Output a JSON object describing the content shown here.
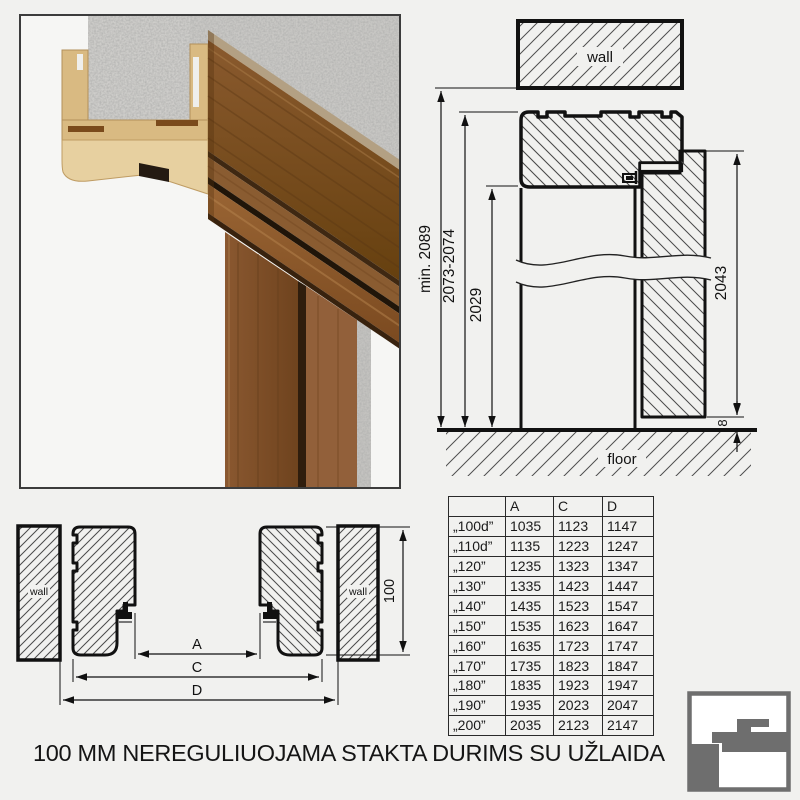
{
  "palette": {
    "logo_gray": "#6e6e6e",
    "wood_dark": "#7d4e28",
    "wood_light": "#9a6a3d",
    "mdf_tan": "#d9ba82",
    "concrete": "#cac9c6",
    "line": "#111111",
    "background": "#f1f1ef"
  },
  "caption": {
    "text": "100 MM NEREGULIUOJAMA STAKTA DURIMS SU UŽLAIDA"
  },
  "section": {
    "wall_label": "wall",
    "floor_label": "floor",
    "dims": {
      "min_total": "min. 2089",
      "frame_height": "2073-2074",
      "opening_height": "2029",
      "door_height": "2043",
      "floor_gap": "8"
    }
  },
  "plan": {
    "wall_label_left": "wall",
    "wall_label_right": "wall",
    "dims": {
      "a": "A",
      "c": "C",
      "d": "D",
      "frame_depth": "100"
    }
  },
  "table": {
    "headers": [
      "",
      "A",
      "C",
      "D"
    ],
    "rows": [
      [
        "„100d”",
        "1035",
        "1123",
        "1147"
      ],
      [
        "„110d”",
        "1135",
        "1223",
        "1247"
      ],
      [
        "„120”",
        "1235",
        "1323",
        "1347"
      ],
      [
        "„130”",
        "1335",
        "1423",
        "1447"
      ],
      [
        "„140”",
        "1435",
        "1523",
        "1547"
      ],
      [
        "„150”",
        "1535",
        "1623",
        "1647"
      ],
      [
        "„160”",
        "1635",
        "1723",
        "1747"
      ],
      [
        "„170”",
        "1735",
        "1823",
        "1847"
      ],
      [
        "„180”",
        "1835",
        "1923",
        "1947"
      ],
      [
        "„190”",
        "1935",
        "2023",
        "2047"
      ],
      [
        "„200”",
        "2035",
        "2123",
        "2147"
      ]
    ]
  }
}
